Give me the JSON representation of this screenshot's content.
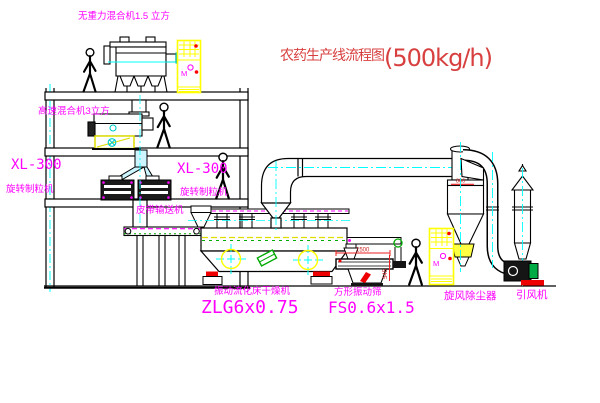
{
  "diagram": {
    "title": {
      "text": "农药生产线流程图",
      "capacity": "(500kg/h)"
    },
    "equipment_labels": {
      "gravity_mixer": "无重力混合机1.5 立方",
      "high_speed_mixer": "高速混合机3立方",
      "granulator_left_model": "XL-300",
      "granulator_left_name": "旋转制粒机",
      "granulator_right_model": "XL-300",
      "granulator_right_name": "旋转制粒机",
      "belt_conveyor": "皮带输送机",
      "dryer_name": "振动流化床干燥机",
      "dryer_model": "ZLG6x0.75",
      "sieve_name": "方形振动筛",
      "sieve_model": "FS0.6x1.5",
      "cyclone": "旋风除尘器",
      "induced_draft_fan": "引风机"
    },
    "dimensions": {
      "cyclone_diameter": "800",
      "sieve_length": "1500",
      "sieve_height": "545"
    },
    "cabinet_marking": "M",
    "colors": {
      "label": "#ff00ff",
      "title": "#d84040",
      "line": "#000000",
      "centerline": "#00ffff",
      "cabinet": "#ffff00",
      "accent_red": "#ff0000",
      "accent_green": "#00aa00"
    }
  }
}
